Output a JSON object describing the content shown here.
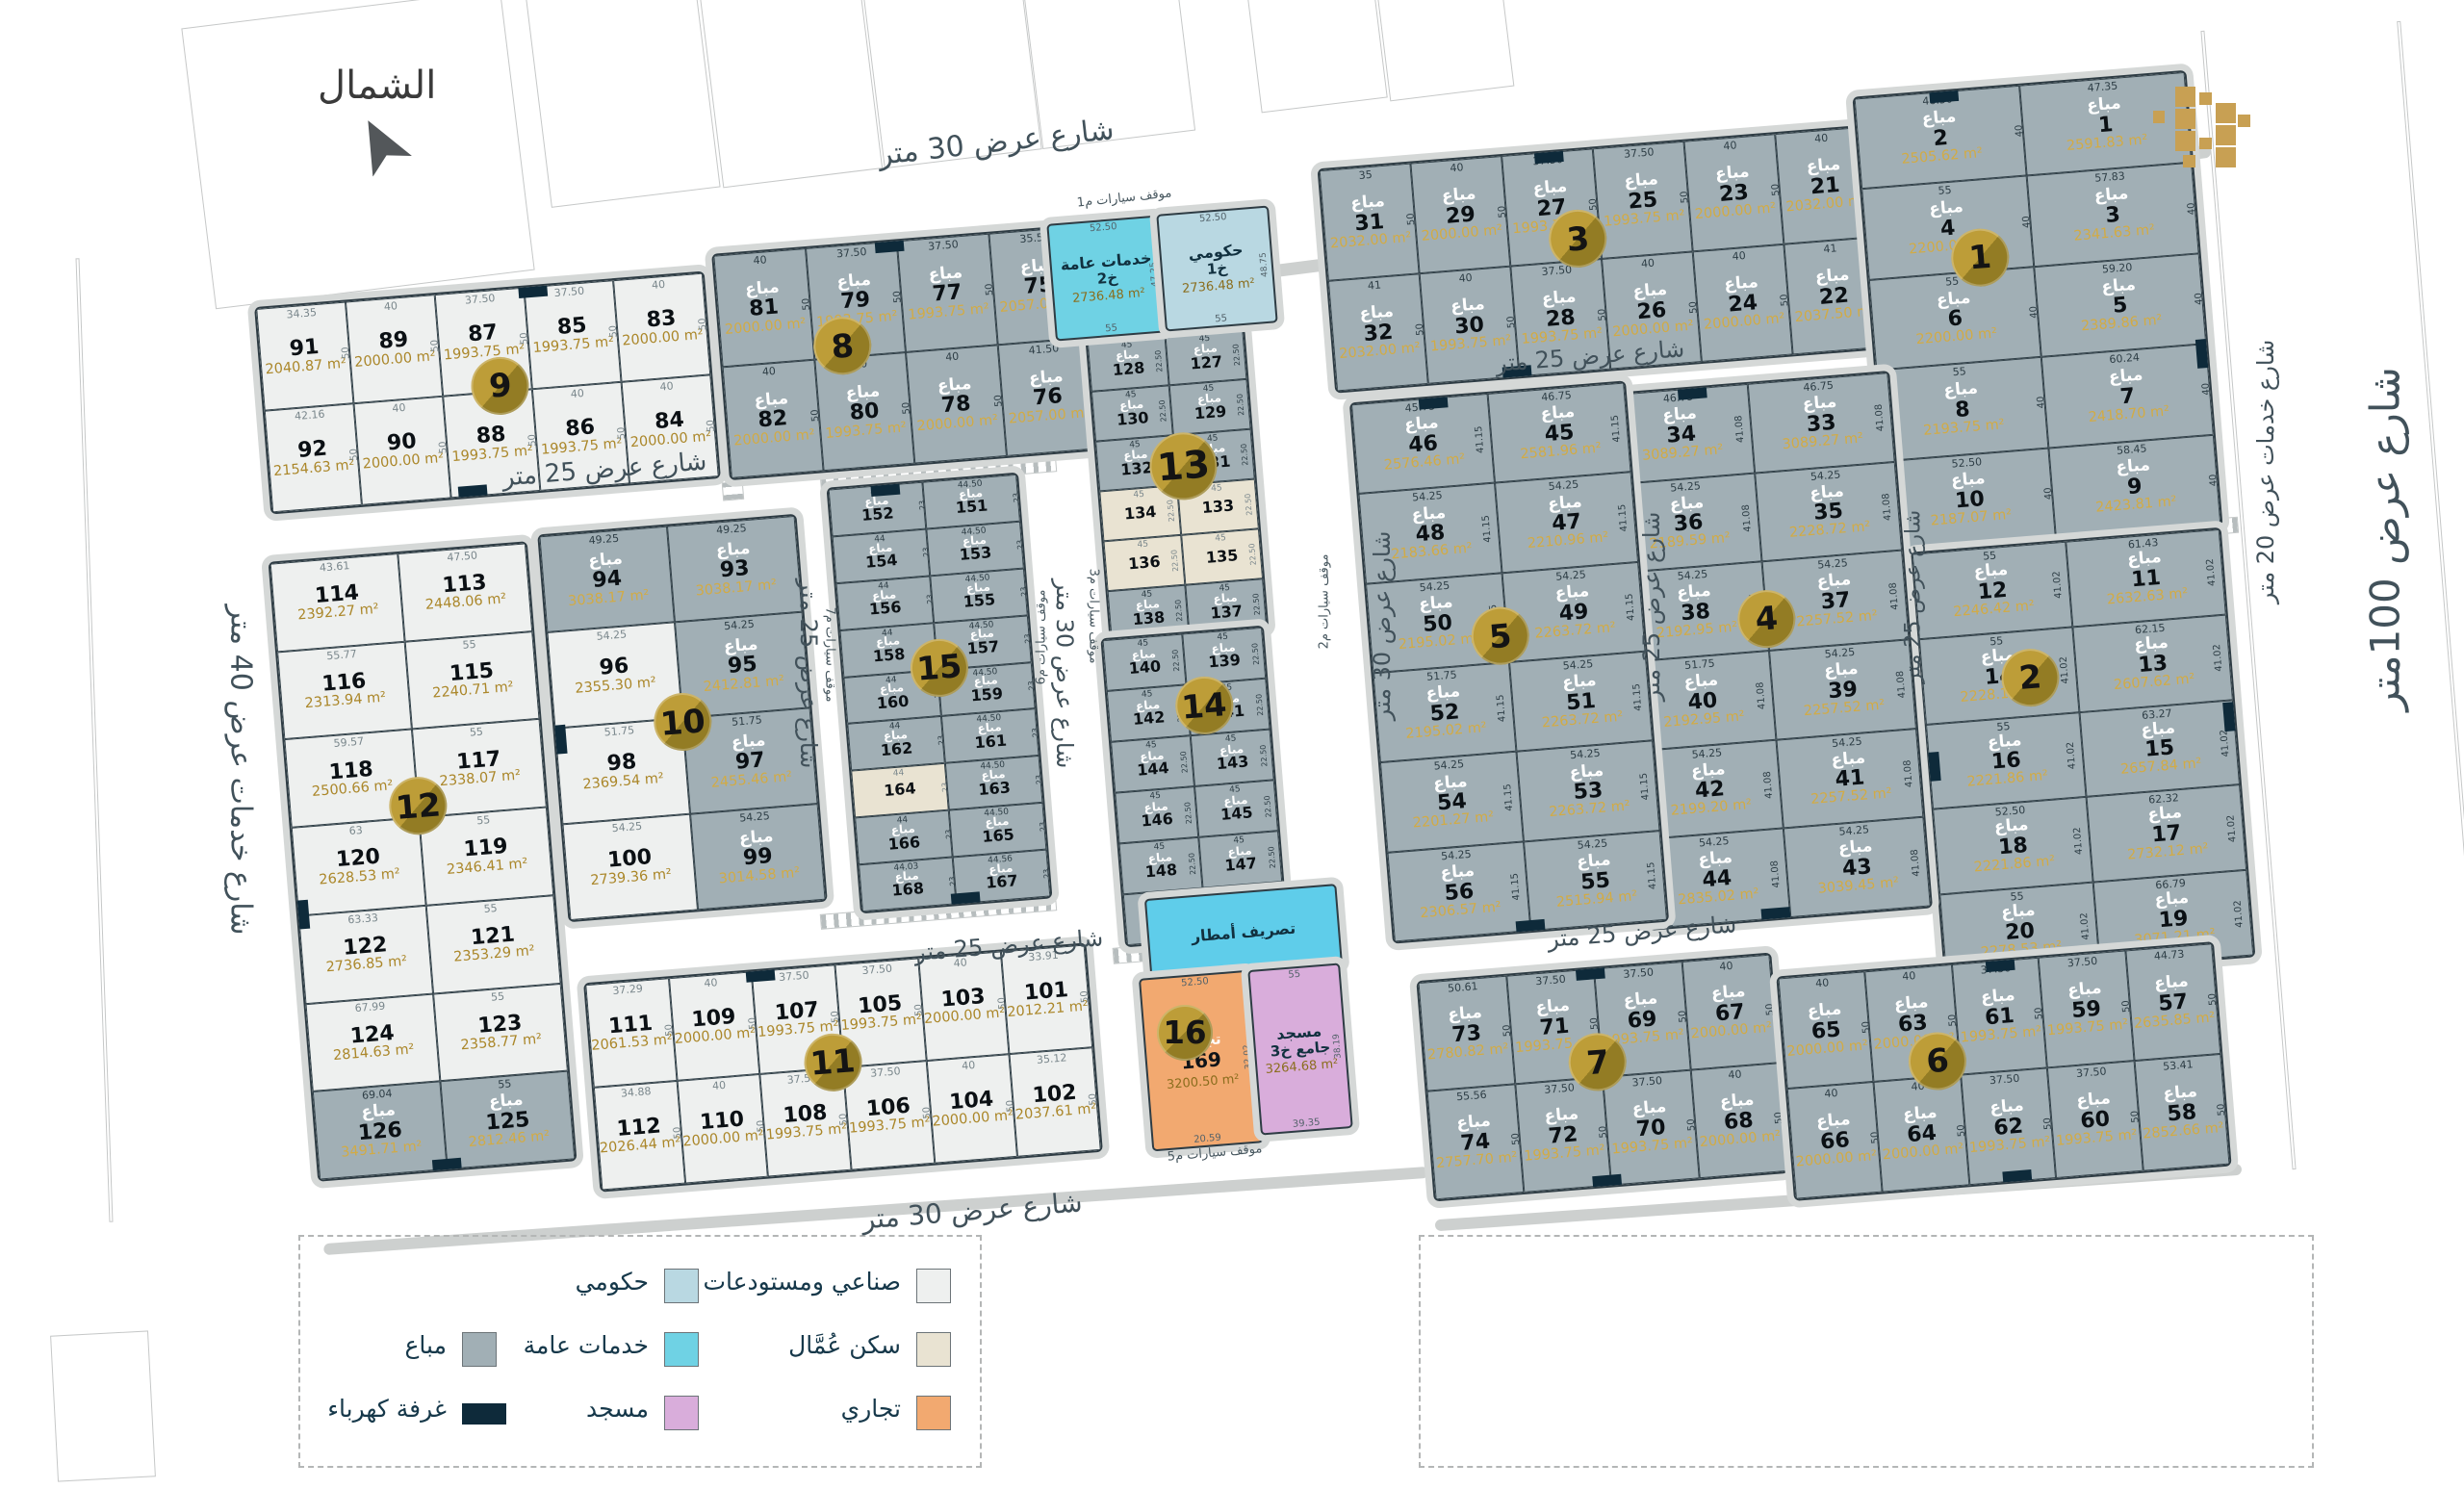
{
  "north_label": "الشمال",
  "sold_label": "مباع",
  "colors": {
    "sold": "#a1afb5",
    "industrial": "#eef0ef",
    "workers": "#e9e3d2",
    "commercial": "#f2a970",
    "government": "#b9d8e2",
    "services": "#6fd2e4",
    "mosque": "#d9addb",
    "storm": "#5fcdea",
    "electric": "#0e2a3a",
    "block_circle_gold": "#ad8c2d",
    "logo_gold": "#c8a053"
  },
  "legend": [
    {
      "key": "industrial",
      "label": "صناعي ومستودعات"
    },
    {
      "key": "workers",
      "label": "سكن عُمَّال"
    },
    {
      "key": "commercial",
      "label": "تجاري"
    },
    {
      "key": "government",
      "label": "حكومي"
    },
    {
      "key": "services",
      "label": "خدمات عامة"
    },
    {
      "key": "mosque",
      "label": "مسجد"
    },
    {
      "key": "sold",
      "label": "مباع"
    },
    {
      "key": "electric",
      "label": "غرفة كهرباء"
    }
  ],
  "streets": [
    "شارع عرض 30 متر",
    "شارع عرض 25 متر",
    "شارع عرض 25 متر",
    "شارع عرض 25 متر",
    "شارع عرض 30 متر",
    "شارع عرض 30 متر",
    "شارع عرض 25 متر",
    "شارع عرض 25 متر",
    "شارع خدمات عرض 20 متر",
    "شارع عرض 100متر",
    "شارع خدمات عرض 40 متر",
    "شارع عرض 25 متر",
    "شارع عرض 25 متر",
    "شارع عرض 30 متر"
  ],
  "parking": [
    "موقف سيارات م1",
    "موقف سيارات م2",
    "موقف سيارات م3",
    "موقف سيارات م5",
    "موقف سيارات م6",
    "موقف سيارات م7"
  ],
  "specials": {
    "services": {
      "name": "خدمات عامة",
      "code": "خ2",
      "area": "2736.48 m²",
      "top": "52.50",
      "side": "47.25",
      "bottom": "55"
    },
    "government": {
      "name": "حكومي",
      "code": "خ1",
      "area": "2736.48 m²",
      "top": "52.50",
      "side": "48.75",
      "bottom": "55"
    },
    "storm": {
      "name": "تصريف أمطار"
    },
    "commercial": {
      "name": "تجاري",
      "plot": "169",
      "area": "3200.50 m²",
      "top": "52.50",
      "side": "32.02",
      "bottom": "20.59"
    },
    "mosque": {
      "name": "مسجد",
      "code": "جامع خ3",
      "area": "3264.68 m²",
      "top": "55",
      "side": "38.19",
      "bottom": "39.35"
    }
  },
  "blocks": [
    {
      "no": "9",
      "def": "ind",
      "sd": "50",
      "plots": [
        {
          "n": "91",
          "a": "2040.87 m²",
          "d": "34.35"
        },
        {
          "n": "89",
          "a": "2000.00 m²",
          "d": "40"
        },
        {
          "n": "87",
          "a": "1993.75 m²",
          "d": "37.50"
        },
        {
          "n": "85",
          "a": "1993.75 m²",
          "d": "37.50"
        },
        {
          "n": "83",
          "a": "2000.00 m²",
          "d": "40"
        },
        {
          "n": "92",
          "a": "2154.63 m²",
          "d": "42.16"
        },
        {
          "n": "90",
          "a": "2000.00 m²",
          "d": "40"
        },
        {
          "n": "88",
          "a": "1993.75 m²",
          "d": "40"
        },
        {
          "n": "86",
          "a": "1993.75 m²",
          "d": "40"
        },
        {
          "n": "84",
          "a": "2000.00 m²",
          "d": "40"
        }
      ]
    },
    {
      "no": "8",
      "def": "sold",
      "sd": "50",
      "plots": [
        {
          "n": "81",
          "a": "2000.00 m²",
          "d": "40"
        },
        {
          "n": "79",
          "a": "1993.75 m²",
          "d": "37.50"
        },
        {
          "n": "77",
          "a": "1993.75 m²",
          "d": "37.50"
        },
        {
          "n": "75",
          "a": "2057.00 m²",
          "d": "35.50"
        },
        {
          "n": "82",
          "a": "2000.00 m²",
          "d": "40"
        },
        {
          "n": "80",
          "a": "1993.75 m²",
          "d": "40"
        },
        {
          "n": "78",
          "a": "2000.00 m²",
          "d": "40"
        },
        {
          "n": "76",
          "a": "2057.00 m²",
          "d": "41.50"
        }
      ]
    },
    {
      "no": "3",
      "def": "sold",
      "sd": "50",
      "plots": [
        {
          "n": "31",
          "a": "2032.00 m²",
          "d": "35"
        },
        {
          "n": "29",
          "a": "2000.00 m²",
          "d": "40"
        },
        {
          "n": "27",
          "a": "1993.75 m²",
          "d": "37.50"
        },
        {
          "n": "25",
          "a": "1993.75 m²",
          "d": "37.50"
        },
        {
          "n": "23",
          "a": "2000.00 m²",
          "d": "40"
        },
        {
          "n": "21",
          "a": "2032.00 m²",
          "d": "40"
        },
        {
          "n": "32",
          "a": "2032.00 m²",
          "d": "41"
        },
        {
          "n": "30",
          "a": "1993.75 m²",
          "d": "40"
        },
        {
          "n": "28",
          "a": "1993.75 m²",
          "d": "37.50"
        },
        {
          "n": "26",
          "a": "2000.00 m²",
          "d": "40"
        },
        {
          "n": "24",
          "a": "2000.00 m²",
          "d": "40"
        },
        {
          "n": "22",
          "a": "2037.50 m²",
          "d": "41"
        }
      ]
    },
    {
      "no": "1",
      "def": "sold",
      "sd": "40",
      "plots": [
        {
          "n": "2",
          "a": "2505.62 m²",
          "d": "46.50"
        },
        {
          "n": "1",
          "a": "2591.83 m²",
          "d": "47.35"
        },
        {
          "n": "4",
          "a": "2200.00 m²",
          "d": "55"
        },
        {
          "n": "3",
          "a": "2341.63 m²",
          "d": "57.83"
        },
        {
          "n": "6",
          "a": "2200.00 m²",
          "d": "55"
        },
        {
          "n": "5",
          "a": "2389.86 m²",
          "d": "59.20"
        },
        {
          "n": "8",
          "a": "2193.75 m²",
          "d": "55"
        },
        {
          "n": "7",
          "a": "2418.70 m²",
          "d": "60.24"
        },
        {
          "n": "10",
          "a": "2187.07 m²",
          "d": "52.50"
        },
        {
          "n": "9",
          "a": "2423.81 m²",
          "d": "58.45"
        }
      ]
    },
    {
      "no": "2",
      "def": "sold",
      "sd": "41.02",
      "plots": [
        {
          "n": "12",
          "a": "2246.42 m²",
          "d": "55"
        },
        {
          "n": "11",
          "a": "2632.63 m²",
          "d": "61.43"
        },
        {
          "n": "14",
          "a": "2228.11 m²",
          "d": "55"
        },
        {
          "n": "13",
          "a": "2607.62 m²",
          "d": "62.15"
        },
        {
          "n": "16",
          "a": "2221.86 m²",
          "d": "55"
        },
        {
          "n": "15",
          "a": "2657.84 m²",
          "d": "63.27"
        },
        {
          "n": "18",
          "a": "2221.86 m²",
          "d": "52.50"
        },
        {
          "n": "17",
          "a": "2732.12 m²",
          "d": "62.32"
        },
        {
          "n": "20",
          "a": "2278.53 m²",
          "d": "55"
        },
        {
          "n": "19",
          "a": "3071.21 m²",
          "d": "66.79"
        }
      ]
    },
    {
      "no": "4",
      "def": "sold",
      "sd": "41.08",
      "plots": [
        {
          "n": "34",
          "a": "3089.27 m²",
          "d": "46.75"
        },
        {
          "n": "33",
          "a": "3089.27 m²",
          "d": "46.75"
        },
        {
          "n": "36",
          "a": "2189.59 m²",
          "d": "54.25"
        },
        {
          "n": "35",
          "a": "2228.72 m²",
          "d": "54.25"
        },
        {
          "n": "38",
          "a": "2192.95 m²",
          "d": "54.25"
        },
        {
          "n": "37",
          "a": "2257.52 m²",
          "d": "54.25"
        },
        {
          "n": "40",
          "a": "2192.95 m²",
          "d": "51.75"
        },
        {
          "n": "39",
          "a": "2257.52 m²",
          "d": "54.25"
        },
        {
          "n": "42",
          "a": "2199.20 m²",
          "d": "54.25"
        },
        {
          "n": "41",
          "a": "2257.52 m²",
          "d": "54.25"
        },
        {
          "n": "44",
          "a": "2835.02 m²",
          "d": "54.25"
        },
        {
          "n": "43",
          "a": "3039.45 m²",
          "d": "54.25"
        }
      ]
    },
    {
      "no": "5",
      "def": "sold",
      "sd": "41.15",
      "plots": [
        {
          "n": "46",
          "a": "2576.46 m²",
          "d": "45.75"
        },
        {
          "n": "45",
          "a": "2581.96 m²",
          "d": "46.75"
        },
        {
          "n": "48",
          "a": "2183.66 m²",
          "d": "54.25"
        },
        {
          "n": "47",
          "a": "2210.96 m²",
          "d": "54.25"
        },
        {
          "n": "50",
          "a": "2195.02 m²",
          "d": "54.25"
        },
        {
          "n": "49",
          "a": "2263.72 m²",
          "d": "54.25"
        },
        {
          "n": "52",
          "a": "2195.02 m²",
          "d": "51.75"
        },
        {
          "n": "51",
          "a": "2263.72 m²",
          "d": "54.25"
        },
        {
          "n": "54",
          "a": "2201.27 m²",
          "d": "54.25"
        },
        {
          "n": "53",
          "a": "2263.72 m²",
          "d": "54.25"
        },
        {
          "n": "56",
          "a": "2306.57 m²",
          "d": "54.25"
        },
        {
          "n": "55",
          "a": "2515.94 m²",
          "d": "54.25"
        }
      ]
    },
    {
      "no": "13",
      "def": "sold",
      "sd": "22.50",
      "plots": [
        {
          "n": "128",
          "d": "45"
        },
        {
          "n": "127",
          "d": "45"
        },
        {
          "n": "130",
          "d": "45"
        },
        {
          "n": "129",
          "d": "45"
        },
        {
          "n": "132",
          "d": "45"
        },
        {
          "n": "131",
          "d": "45"
        },
        {
          "n": "134",
          "d": "45",
          "s": "wrk"
        },
        {
          "n": "133",
          "d": "45",
          "s": "wrk"
        },
        {
          "n": "136",
          "d": "45",
          "s": "wrk"
        },
        {
          "n": "135",
          "d": "45",
          "s": "wrk"
        },
        {
          "n": "138",
          "d": "45"
        },
        {
          "n": "137",
          "d": "45"
        }
      ]
    },
    {
      "no": "14",
      "def": "sold",
      "sd": "22.50",
      "plots": [
        {
          "n": "140",
          "d": "45"
        },
        {
          "n": "139",
          "d": "45"
        },
        {
          "n": "142",
          "d": "45"
        },
        {
          "n": "141",
          "d": "45"
        },
        {
          "n": "144",
          "d": "45"
        },
        {
          "n": "143",
          "d": "45"
        },
        {
          "n": "146",
          "d": "45"
        },
        {
          "n": "145",
          "d": "45"
        },
        {
          "n": "148",
          "d": "45"
        },
        {
          "n": "147",
          "d": "45"
        },
        {
          "n": "150",
          "d": "45"
        },
        {
          "n": "149",
          "d": "45"
        }
      ]
    },
    {
      "no": "15",
      "def": "sold",
      "sd": "23",
      "plots": [
        {
          "n": "152",
          "d": "44"
        },
        {
          "n": "151",
          "d": "44.50"
        },
        {
          "n": "154",
          "d": "44"
        },
        {
          "n": "153",
          "d": "44.50"
        },
        {
          "n": "156",
          "d": "44"
        },
        {
          "n": "155",
          "d": "44.50"
        },
        {
          "n": "158",
          "d": "44"
        },
        {
          "n": "157",
          "d": "44.50"
        },
        {
          "n": "160",
          "d": "44"
        },
        {
          "n": "159",
          "d": "44.50"
        },
        {
          "n": "162",
          "d": "44"
        },
        {
          "n": "161",
          "d": "44.50"
        },
        {
          "n": "164",
          "d": "44",
          "s": "wrk"
        },
        {
          "n": "163",
          "d": "44.50"
        },
        {
          "n": "166",
          "d": "44"
        },
        {
          "n": "165",
          "d": "44.50"
        },
        {
          "n": "168",
          "d": "44.03"
        },
        {
          "n": "167",
          "d": "44.56"
        }
      ]
    },
    {
      "no": "10",
      "def": "sold",
      "plots": [
        {
          "n": "94",
          "a": "3038.17 m²",
          "d": "49.25"
        },
        {
          "n": "93",
          "a": "3038.17 m²",
          "d": "49.25"
        },
        {
          "n": "96",
          "a": "2355.30 m²",
          "d": "54.25",
          "s": "ind"
        },
        {
          "n": "95",
          "a": "2412.81 m²",
          "d": "54.25"
        },
        {
          "n": "98",
          "a": "2369.54 m²",
          "d": "51.75",
          "s": "ind"
        },
        {
          "n": "97",
          "a": "2455.46 m²",
          "d": "51.75"
        },
        {
          "n": "100",
          "a": "2739.36 m²",
          "d": "54.25",
          "s": "ind"
        },
        {
          "n": "99",
          "a": "3014.58 m²",
          "d": "54.25"
        }
      ]
    },
    {
      "no": "12",
      "def": "ind",
      "plots": [
        {
          "n": "114",
          "a": "2392.27 m²",
          "d": "43.61"
        },
        {
          "n": "113",
          "a": "2448.06 m²",
          "d": "47.50"
        },
        {
          "n": "116",
          "a": "2313.94 m²",
          "d": "55.77"
        },
        {
          "n": "115",
          "a": "2240.71 m²",
          "d": "55"
        },
        {
          "n": "118",
          "a": "2500.66 m²",
          "d": "59.57"
        },
        {
          "n": "117",
          "a": "2338.07 m²",
          "d": "55"
        },
        {
          "n": "120",
          "a": "2628.53 m²",
          "d": "63"
        },
        {
          "n": "119",
          "a": "2346.41 m²",
          "d": "55"
        },
        {
          "n": "122",
          "a": "2736.85 m²",
          "d": "63.33"
        },
        {
          "n": "121",
          "a": "2353.29 m²",
          "d": "55"
        },
        {
          "n": "124",
          "a": "2814.63 m²",
          "d": "67.99"
        },
        {
          "n": "123",
          "a": "2358.77 m²",
          "d": "55"
        },
        {
          "n": "126",
          "a": "3491.71 m²",
          "d": "69.04",
          "s": "sold"
        },
        {
          "n": "125",
          "a": "2812.46 m²",
          "d": "55",
          "s": "sold"
        }
      ]
    },
    {
      "no": "11",
      "def": "ind",
      "sd": "50",
      "plots": [
        {
          "n": "111",
          "a": "2061.53 m²",
          "d": "37.29"
        },
        {
          "n": "109",
          "a": "2000.00 m²",
          "d": "40"
        },
        {
          "n": "107",
          "a": "1993.75 m²",
          "d": "37.50"
        },
        {
          "n": "105",
          "a": "1993.75 m²",
          "d": "37.50"
        },
        {
          "n": "103",
          "a": "2000.00 m²",
          "d": "40"
        },
        {
          "n": "101",
          "a": "2012.21 m²",
          "d": "33.91"
        },
        {
          "n": "112",
          "a": "2026.44 m²",
          "d": "34.88"
        },
        {
          "n": "110",
          "a": "2000.00 m²",
          "d": "40"
        },
        {
          "n": "108",
          "a": "1993.75 m²",
          "d": "37.50"
        },
        {
          "n": "106",
          "a": "1993.75 m²",
          "d": "37.50"
        },
        {
          "n": "104",
          "a": "2000.00 m²",
          "d": "40"
        },
        {
          "n": "102",
          "a": "2037.61 m²",
          "d": "35.12"
        }
      ]
    },
    {
      "no": "7",
      "def": "sold",
      "sd": "50",
      "plots": [
        {
          "n": "73",
          "a": "2780.82 m²",
          "d": "50.61"
        },
        {
          "n": "71",
          "a": "1993.75 m²",
          "d": "37.50"
        },
        {
          "n": "69",
          "a": "1993.75 m²",
          "d": "37.50"
        },
        {
          "n": "67",
          "a": "2000.00 m²",
          "d": "40"
        },
        {
          "n": "74",
          "a": "2757.70 m²",
          "d": "55.56"
        },
        {
          "n": "72",
          "a": "1993.75 m²",
          "d": "37.50"
        },
        {
          "n": "70",
          "a": "1993.75 m²",
          "d": "37.50"
        },
        {
          "n": "68",
          "a": "2000.00 m²",
          "d": "40"
        }
      ]
    },
    {
      "no": "6",
      "def": "sold",
      "sd": "50",
      "plots": [
        {
          "n": "65",
          "a": "2000.00 m²",
          "d": "40"
        },
        {
          "n": "63",
          "a": "2000.00 m²",
          "d": "40"
        },
        {
          "n": "61",
          "a": "1993.75 m²",
          "d": "37.50"
        },
        {
          "n": "59",
          "a": "1993.75 m²",
          "d": "37.50"
        },
        {
          "n": "57",
          "a": "2635.85 m²",
          "d": "44.73"
        },
        {
          "n": "66",
          "a": "2000.00 m²",
          "d": "40"
        },
        {
          "n": "64",
          "a": "2000.00 m²",
          "d": "40"
        },
        {
          "n": "62",
          "a": "1993.75 m²",
          "d": "37.50"
        },
        {
          "n": "60",
          "a": "1993.75 m²",
          "d": "37.50"
        },
        {
          "n": "58",
          "a": "2852.66 m²",
          "d": "53.41"
        }
      ]
    }
  ]
}
